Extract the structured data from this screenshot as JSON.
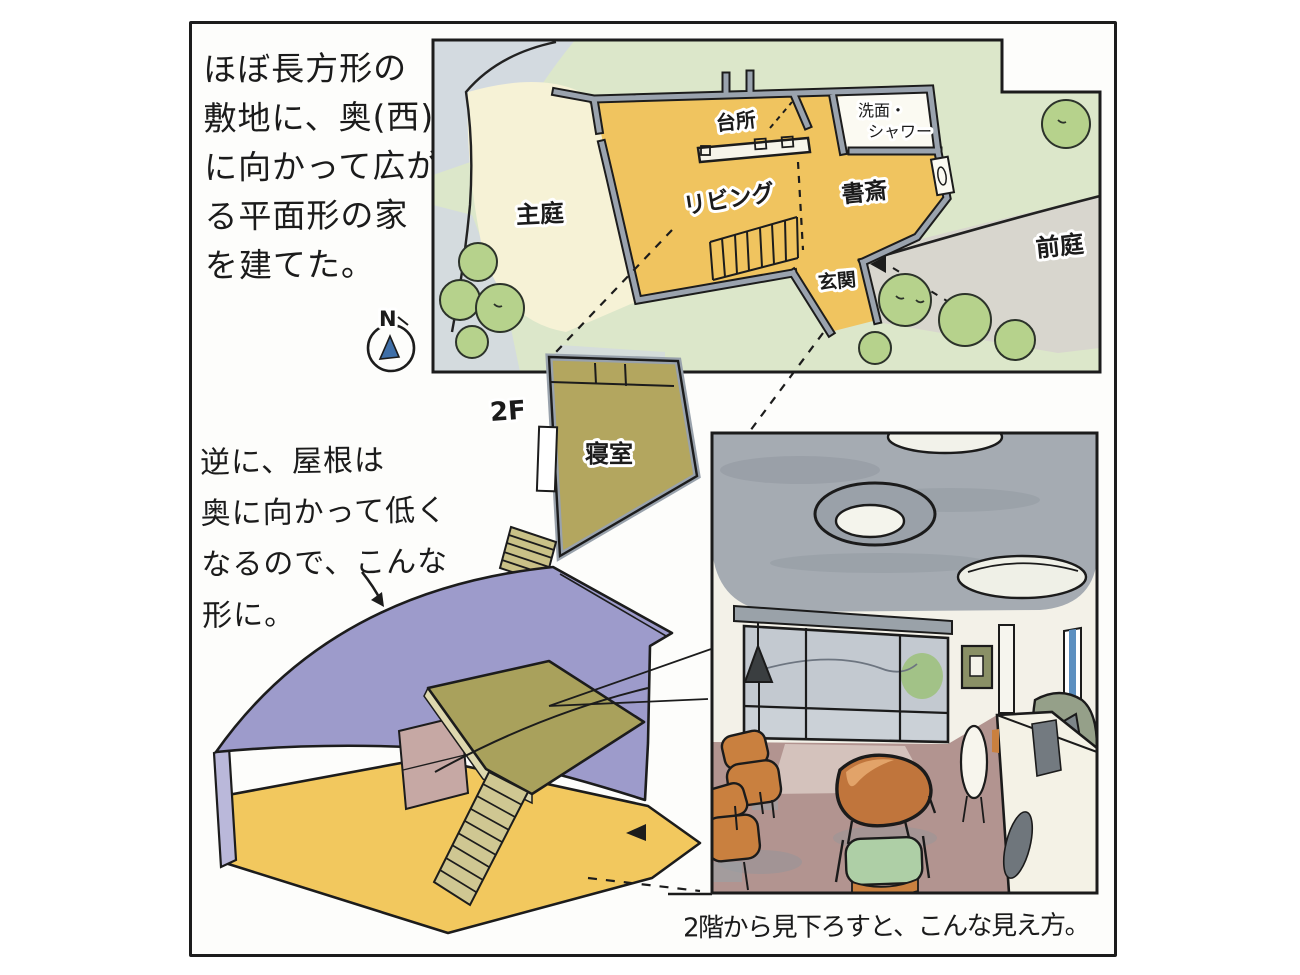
{
  "notes": {
    "top_left": [
      "ほぼ長方形の",
      "敷地に、奥(西)",
      "に向かって広が",
      "る平面形の家",
      "を建てた。"
    ],
    "mid_left": [
      "逆に、屋根は",
      "奥に向かって低く",
      "なるので、こんな",
      "形に。"
    ],
    "caption": "2階から見下ろすと、こんな見え方。"
  },
  "site_plan": {
    "labels": {
      "main_garden": "主庭",
      "front_garden": "前庭",
      "kitchen": "台所",
      "washroom_line1": "洗面・",
      "washroom_line2": "シャワー",
      "living": "リビング",
      "study": "書斎",
      "entrance": "玄関"
    }
  },
  "floor2": {
    "level": "2F",
    "bedroom": "寝室"
  },
  "compass": {
    "north": "N"
  },
  "colors": {
    "floor_yellow": "#f0c45f",
    "wall_gray": "#9aa3ae",
    "lawn_green": "#dce7ca",
    "tree_green": "#b6d28c",
    "garden_cream": "#f6f2d6",
    "front_garden_gray": "#d8d6ce",
    "patch_blue_gray": "#d2d8e2",
    "plan2f_olive": "#b3a65f",
    "stair_olive": "#c9c187",
    "roof_purple": "#9d9bcb",
    "iso_wall_pink": "#c6a8a4",
    "platform_olive": "#a9a15c",
    "ceiling_gray": "#a5abb2",
    "interior_floor_mauve": "#b29490",
    "wood_chair_orange": "#c9803f",
    "table_wood": "#c0753c",
    "cushion_green": "#aecfa6",
    "window_blue": "#5b8fc0",
    "compass_needle_blue": "#3f6fa8",
    "ink": "#1c1c1c"
  }
}
